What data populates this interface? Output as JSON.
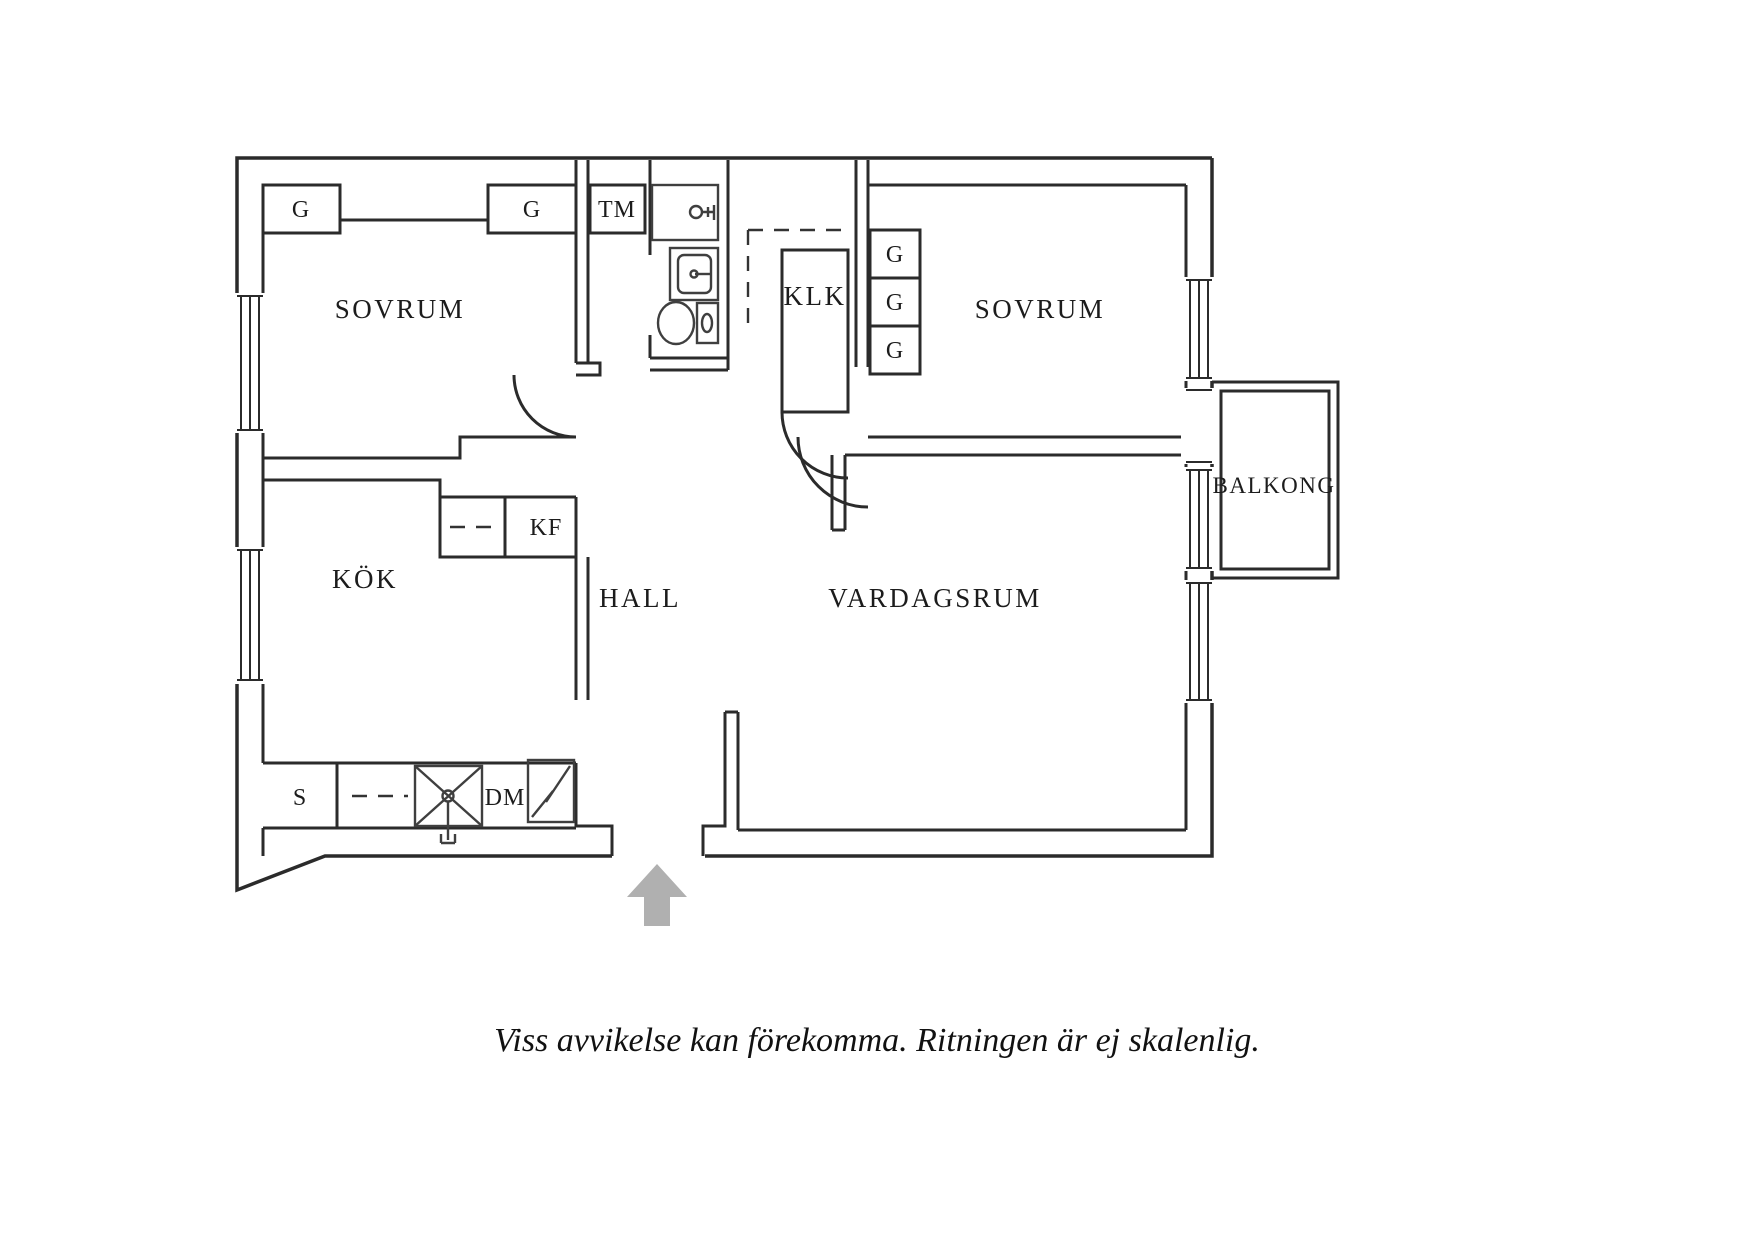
{
  "caption": "Viss avvikelse kan förekomma. Ritningen är ej skalenlig.",
  "rooms": {
    "sovrum1": "SOVRUM",
    "sovrum2": "SOVRUM",
    "kok": "KÖK",
    "hall": "HALL",
    "vardagsrum": "VARDAGSRUM",
    "balkong": "BALKONG",
    "klk": "KLK"
  },
  "fixtures": {
    "tm": "TM",
    "kf": "KF",
    "dm": "DM",
    "s": "S",
    "g1": "G",
    "g2": "G",
    "g3": "G",
    "g4": "G",
    "g5": "G"
  },
  "colors": {
    "wall": "#2b2b2b",
    "fixture": "#3f3f3f",
    "arrow": "#b0b0b0",
    "text": "#1c1c1c"
  }
}
